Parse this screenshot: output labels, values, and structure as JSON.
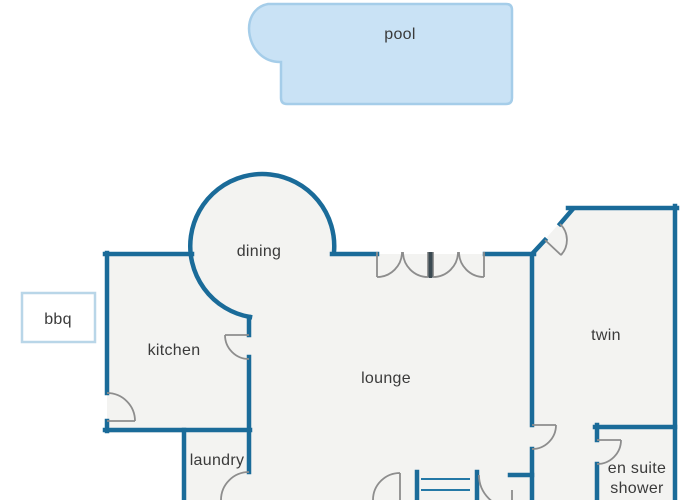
{
  "diagram_type": "house-floor-plan",
  "colors": {
    "wall": "#1a6b99",
    "room_fill": "#f3f3f1",
    "pool_fill": "#c9e2f5",
    "pool_stroke": "#a5cde9",
    "bbq_stroke": "#b9d6e8",
    "door_swing": "#8d8d8d",
    "label_text": "#3a3a3a"
  },
  "labels": {
    "pool": "pool",
    "dining": "dining",
    "bbq": "bbq",
    "kitchen": "kitchen",
    "lounge": "lounge",
    "twin": "twin",
    "laundry": "laundry",
    "ensuite_line1": "en suite",
    "ensuite_line2": "shower"
  }
}
